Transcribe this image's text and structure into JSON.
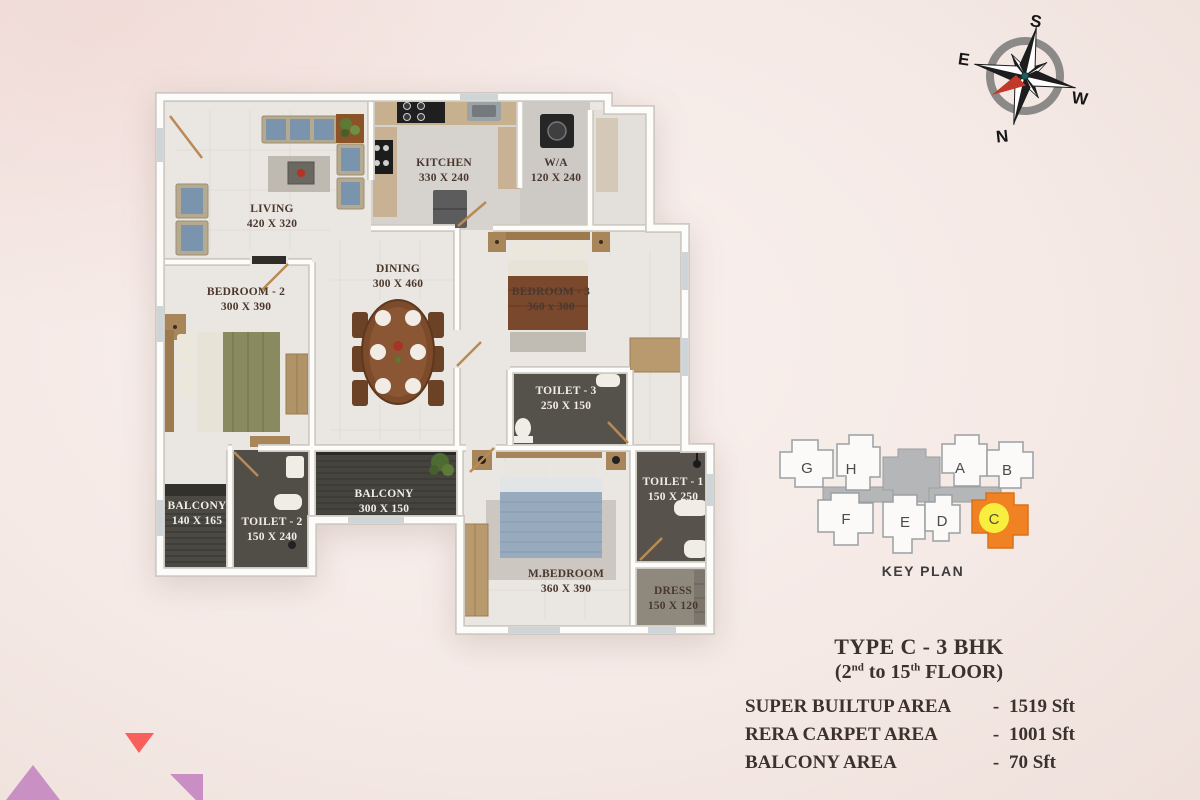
{
  "palette": {
    "background": "#f5eae6",
    "accent_red_triangle": "#f9605b",
    "accent_purple_triangle": "#c890c3",
    "keyplan_highlight": "#f08224",
    "keyplan_circle": "#f7ee3e",
    "compass_needle": "#c0392b"
  },
  "compass": {
    "south": "S",
    "east": "E",
    "west": "W",
    "north": "N"
  },
  "floorplan": {
    "rooms": [
      {
        "id": "living",
        "name": "LIVING",
        "dims": "420 X 320"
      },
      {
        "id": "kitchen",
        "name": "KITCHEN",
        "dims": "330 X 240"
      },
      {
        "id": "wa",
        "name": "W/A",
        "dims": "120 X 240"
      },
      {
        "id": "bedroom2",
        "name": "BEDROOM - 2",
        "dims": "300 X 390"
      },
      {
        "id": "dining",
        "name": "DINING",
        "dims": "300 X 460"
      },
      {
        "id": "bedroom3",
        "name": "BEDROOM - 3",
        "dims": "360 x 300"
      },
      {
        "id": "toilet3",
        "name": "TOILET - 3",
        "dims": "250 X 150"
      },
      {
        "id": "balcony1",
        "name": "BALCONY",
        "dims": "140 X 165"
      },
      {
        "id": "toilet2",
        "name": "TOILET - 2",
        "dims": "150 X 240"
      },
      {
        "id": "balcony2",
        "name": "BALCONY",
        "dims": "300 X 150"
      },
      {
        "id": "mbedroom",
        "name": "M.BEDROOM",
        "dims": "360 X 390"
      },
      {
        "id": "toilet1",
        "name": "TOILET - 1",
        "dims": "150 X 250"
      },
      {
        "id": "dress",
        "name": "DRESS",
        "dims": "150 X 120"
      }
    ]
  },
  "keyplan": {
    "title": "KEY PLAN",
    "units": [
      "G",
      "H",
      "A",
      "B",
      "F",
      "E",
      "D",
      "C"
    ]
  },
  "info": {
    "title": "TYPE C - 3 BHK",
    "floor_open": "(2",
    "floor_sup1": "nd",
    "floor_mid": " to 15",
    "floor_sup2": "th",
    "floor_close": " FLOOR)",
    "areas": [
      {
        "label": "SUPER BUILTUP AREA",
        "sep": "-",
        "value": "1519 Sft"
      },
      {
        "label": "RERA CARPET AREA",
        "sep": "-",
        "value": "1001 Sft"
      },
      {
        "label": "BALCONY AREA",
        "sep": "-",
        "value": "70 Sft"
      }
    ]
  }
}
